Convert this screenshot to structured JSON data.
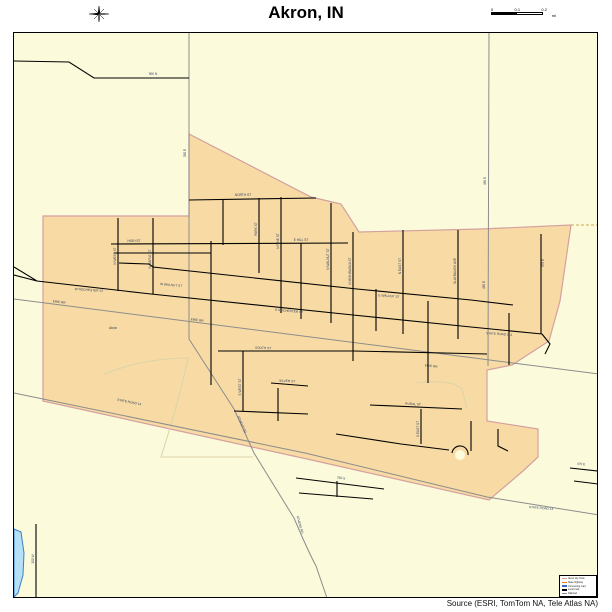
{
  "title": "Akron, IN",
  "source": "Source (ESRI, TomTom NA, Tele Atlas NA)",
  "scalebar": {
    "ticks": [
      "0",
      "0.1",
      "0.2"
    ],
    "unit": "mi"
  },
  "legend": {
    "items": [
      {
        "label": "Akron city limits",
        "color": "#d4a0a0"
      },
      {
        "label": "State highway",
        "color": "#e8821e"
      },
      {
        "label": "Connecting road",
        "color": "#3a6bc8"
      },
      {
        "label": "Local road",
        "color": "#000000"
      },
      {
        "label": "Railroad",
        "color": "#8c8c8c"
      }
    ]
  },
  "map": {
    "place": "Akron",
    "colors": {
      "background": "#fbfbdc",
      "place_fill": "#f8dba4",
      "place_border": "#d4a0a0",
      "road": "#000000",
      "minor_road": "#8c8c8c",
      "stream": "#dcd3a8",
      "water_fill": "#b5e0f6",
      "water_border": "#3f7fc4",
      "label": "#2e3e5c"
    },
    "street_labels": [
      {
        "t": "900 N",
        "x": 152,
        "y": 74,
        "r": 0
      },
      {
        "t": "350 E",
        "x": 185,
        "y": 152,
        "r": -90
      },
      {
        "t": "450 E",
        "x": 485,
        "y": 180,
        "r": -90
      },
      {
        "t": "450 E",
        "x": 484,
        "y": 284,
        "r": -90
      },
      {
        "t": "N WEST ST",
        "x": 115,
        "y": 255,
        "r": -90
      },
      {
        "t": "N MAPLE ST",
        "x": 150,
        "y": 258,
        "r": -90
      },
      {
        "t": "HIGH ST",
        "x": 133,
        "y": 241,
        "r": 0
      },
      {
        "t": "NORTH ST",
        "x": 242,
        "y": 195,
        "r": 0
      },
      {
        "t": "PARK ST",
        "x": 256,
        "y": 228,
        "r": -90
      },
      {
        "t": "N PINE ST",
        "x": 278,
        "y": 240,
        "r": -90
      },
      {
        "t": "E HILL ST",
        "x": 300,
        "y": 240,
        "r": 0
      },
      {
        "t": "N WALNUT ST",
        "x": 328,
        "y": 258,
        "r": -90
      },
      {
        "t": "N MISHAWAKA ST",
        "x": 350,
        "y": 270,
        "r": -90
      },
      {
        "t": "N EAST ST",
        "x": 400,
        "y": 265,
        "r": -90
      },
      {
        "t": "SLAYBAUGH AVE",
        "x": 455,
        "y": 270,
        "r": -90
      },
      {
        "t": "375 E",
        "x": 543,
        "y": 262,
        "r": -90
      },
      {
        "t": "W ROCHESTER ST",
        "x": 88,
        "y": 290,
        "r": 4
      },
      {
        "t": "E ROCHESTER ST",
        "x": 288,
        "y": 311,
        "r": 5
      },
      {
        "t": "STATE ROAD 114",
        "x": 498,
        "y": 334,
        "r": 4
      },
      {
        "t": "W WALNUT ST",
        "x": 170,
        "y": 285,
        "r": 5
      },
      {
        "t": "E WALNUT ST",
        "x": 388,
        "y": 296,
        "r": 4
      },
      {
        "t": "ERIE RR",
        "x": 58,
        "y": 302,
        "r": 7
      },
      {
        "t": "ERIE RR",
        "x": 196,
        "y": 320,
        "r": 7
      },
      {
        "t": "ERIE RR",
        "x": 430,
        "y": 366,
        "r": 7
      },
      {
        "t": "Akron",
        "x": 112,
        "y": 328,
        "r": 0
      },
      {
        "t": "STATE ROAD 14",
        "x": 128,
        "y": 402,
        "r": 11
      },
      {
        "t": "STATE ROAD 14",
        "x": 540,
        "y": 508,
        "r": 5
      },
      {
        "t": "ATHENS RD",
        "x": 240,
        "y": 424,
        "r": 66
      },
      {
        "t": "ATHENS RD",
        "x": 298,
        "y": 524,
        "r": 74
      },
      {
        "t": "SOUTH ST",
        "x": 262,
        "y": 348,
        "r": 2
      },
      {
        "t": "SILVER ST",
        "x": 286,
        "y": 381,
        "r": 3
      },
      {
        "t": "RURAL ST",
        "x": 412,
        "y": 404,
        "r": 3
      },
      {
        "t": "S WEST ST",
        "x": 240,
        "y": 386,
        "r": -90
      },
      {
        "t": "S EAST ST",
        "x": 418,
        "y": 428,
        "r": -90
      },
      {
        "t": "250 S",
        "x": 340,
        "y": 478,
        "r": 8
      },
      {
        "t": "100 W",
        "x": 33,
        "y": 558,
        "r": -90
      },
      {
        "t": "475 E",
        "x": 580,
        "y": 464,
        "r": 3
      }
    ]
  }
}
